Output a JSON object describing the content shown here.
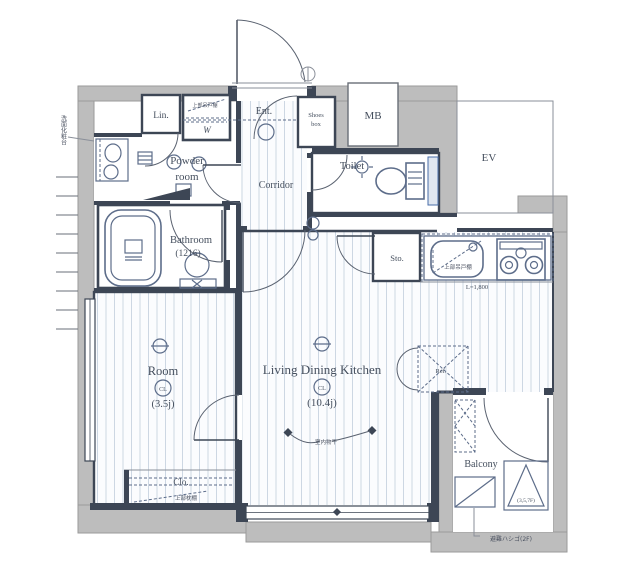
{
  "plan": {
    "rooms": {
      "lin": {
        "label": "Lin."
      },
      "washer": {
        "symbol": "W",
        "note": "上部吊戸棚"
      },
      "powder": {
        "line1": "Powder",
        "line2": "room"
      },
      "entrance": {
        "label": "Ent."
      },
      "shoes": {
        "line1": "Shoes",
        "line2": "box"
      },
      "mb": {
        "label": "MB"
      },
      "ev": {
        "label": "EV"
      },
      "corridor": {
        "label": "Corridor"
      },
      "toilet": {
        "label": "Toilet"
      },
      "bathroom": {
        "label": "Bathroom",
        "size": "(1216)"
      },
      "storage": {
        "label": "Sto."
      },
      "kitchen": {
        "note": "上部吊戸棚",
        "length": "L=1,800"
      },
      "ldk": {
        "label": "Living Dining Kitchen",
        "closet_mark": "CL",
        "size": "(10.4j)"
      },
      "room": {
        "label": "Room",
        "closet_mark": "CL",
        "size": "(3.5j)"
      },
      "closet": {
        "label": "Clo.",
        "note": "上部枕棚"
      },
      "balcony": {
        "label": "Balcony",
        "hatch_floors": "(3,5,7F)",
        "ladder_note": "避難ハシゴ(2F)"
      },
      "refrigerator": {
        "label": "Ref."
      }
    },
    "annotations": {
      "indoor_drying": "室内物干",
      "vanity_note": "洗面化粧台"
    },
    "colors": {
      "exterior_wall": "#bdbdbd",
      "interior_wall": "#3d4655",
      "floor_stripe": "#cdd7e3",
      "fixture": "#5d6d8a",
      "accent": "#4a6da8",
      "text": "#454f5e"
    }
  }
}
